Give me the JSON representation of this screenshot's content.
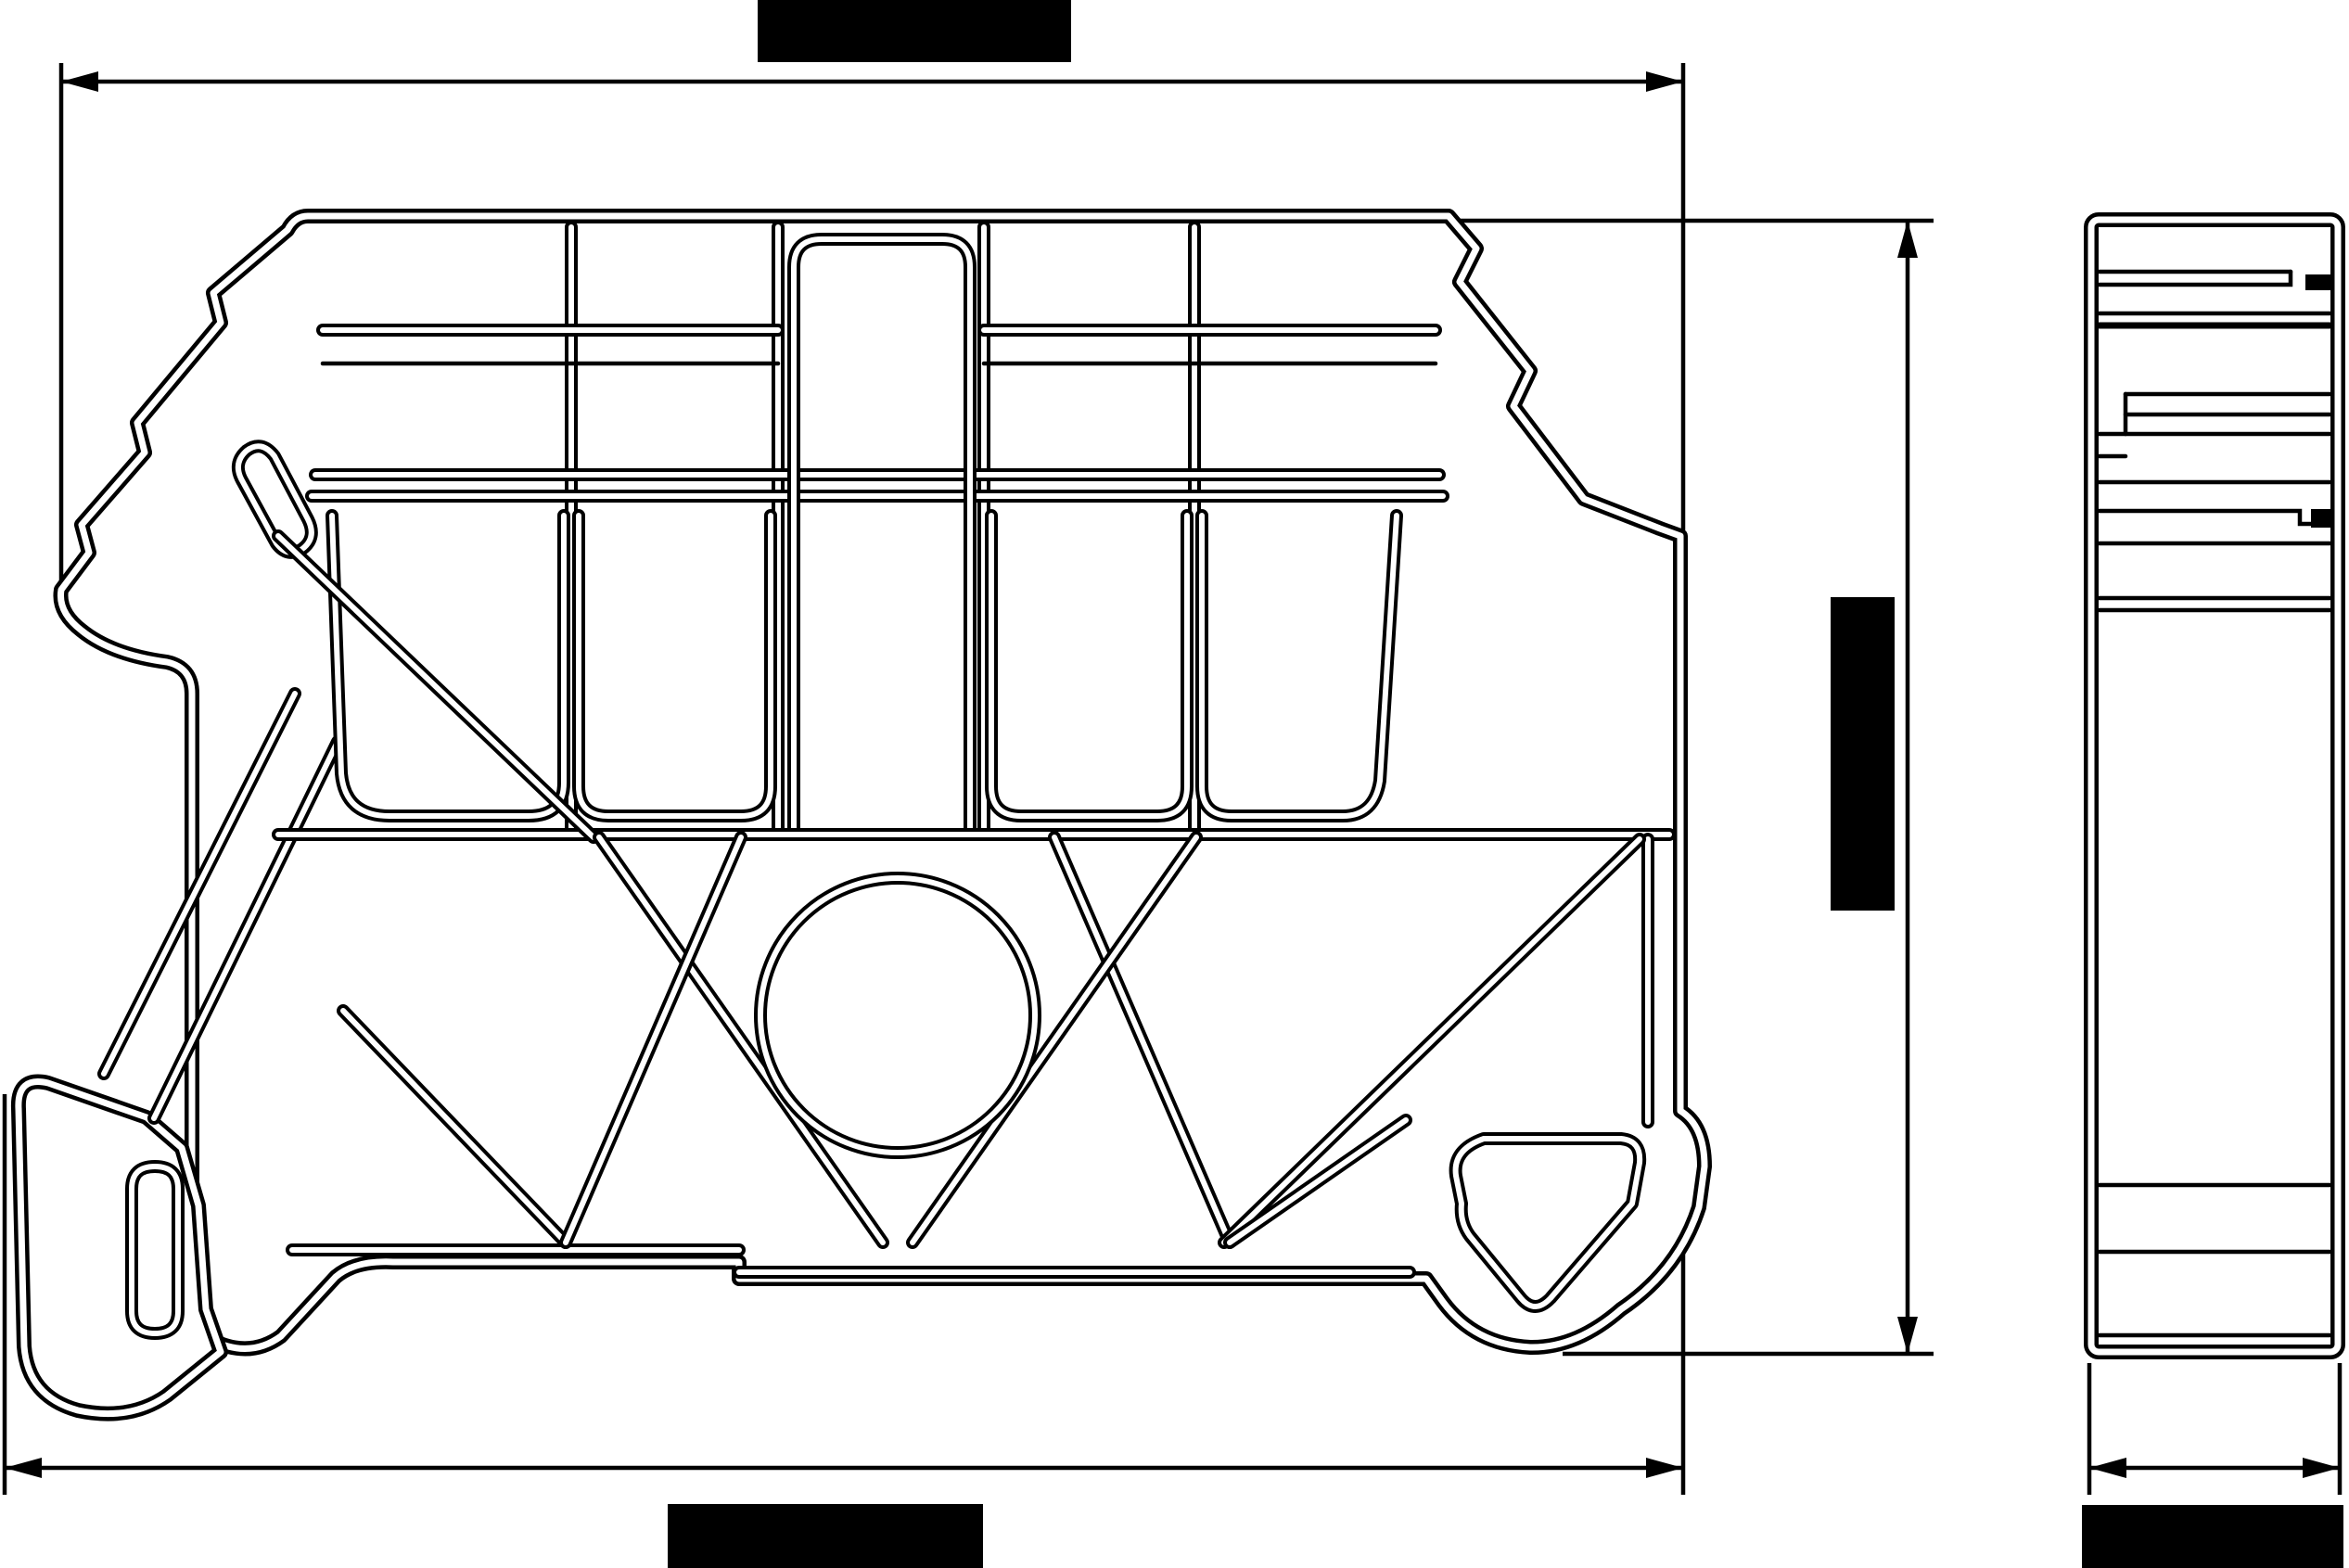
{
  "document": {
    "type": "technical-drawing",
    "description": "Two-view CAD line drawing of a DIN-rail end bracket / terminal block end support with redacted dimension labels",
    "background_color": "#ffffff",
    "line_color": "#000000",
    "text_visible": false
  },
  "views": {
    "front": {
      "name": "front profile view",
      "contents": "bracket profile with comb compartments, cross bracing, center hole, DIN-rail clip and mounting foot"
    },
    "side": {
      "name": "side elevation view",
      "contents": "narrow stacked-layer profile"
    }
  },
  "dimensions": {
    "top_width": {
      "label": "REDACTED",
      "redacted": true,
      "orientation": "horizontal",
      "position": "top",
      "label_color": "#000000"
    },
    "overall_height": {
      "label": "REDACTED",
      "redacted": true,
      "orientation": "vertical",
      "position": "right-of-front-view",
      "label_color": "#000000"
    },
    "overall_width": {
      "label": "REDACTED",
      "redacted": true,
      "orientation": "horizontal",
      "position": "bottom",
      "label_color": "#000000"
    },
    "side_depth": {
      "label": "REDACTED",
      "redacted": true,
      "orientation": "horizontal",
      "position": "bottom-of-side-view",
      "label_color": "#000000"
    }
  },
  "icons": {
    "dimension_arrow": "filled triangular arrowhead",
    "extension_line": "thin solid line"
  }
}
